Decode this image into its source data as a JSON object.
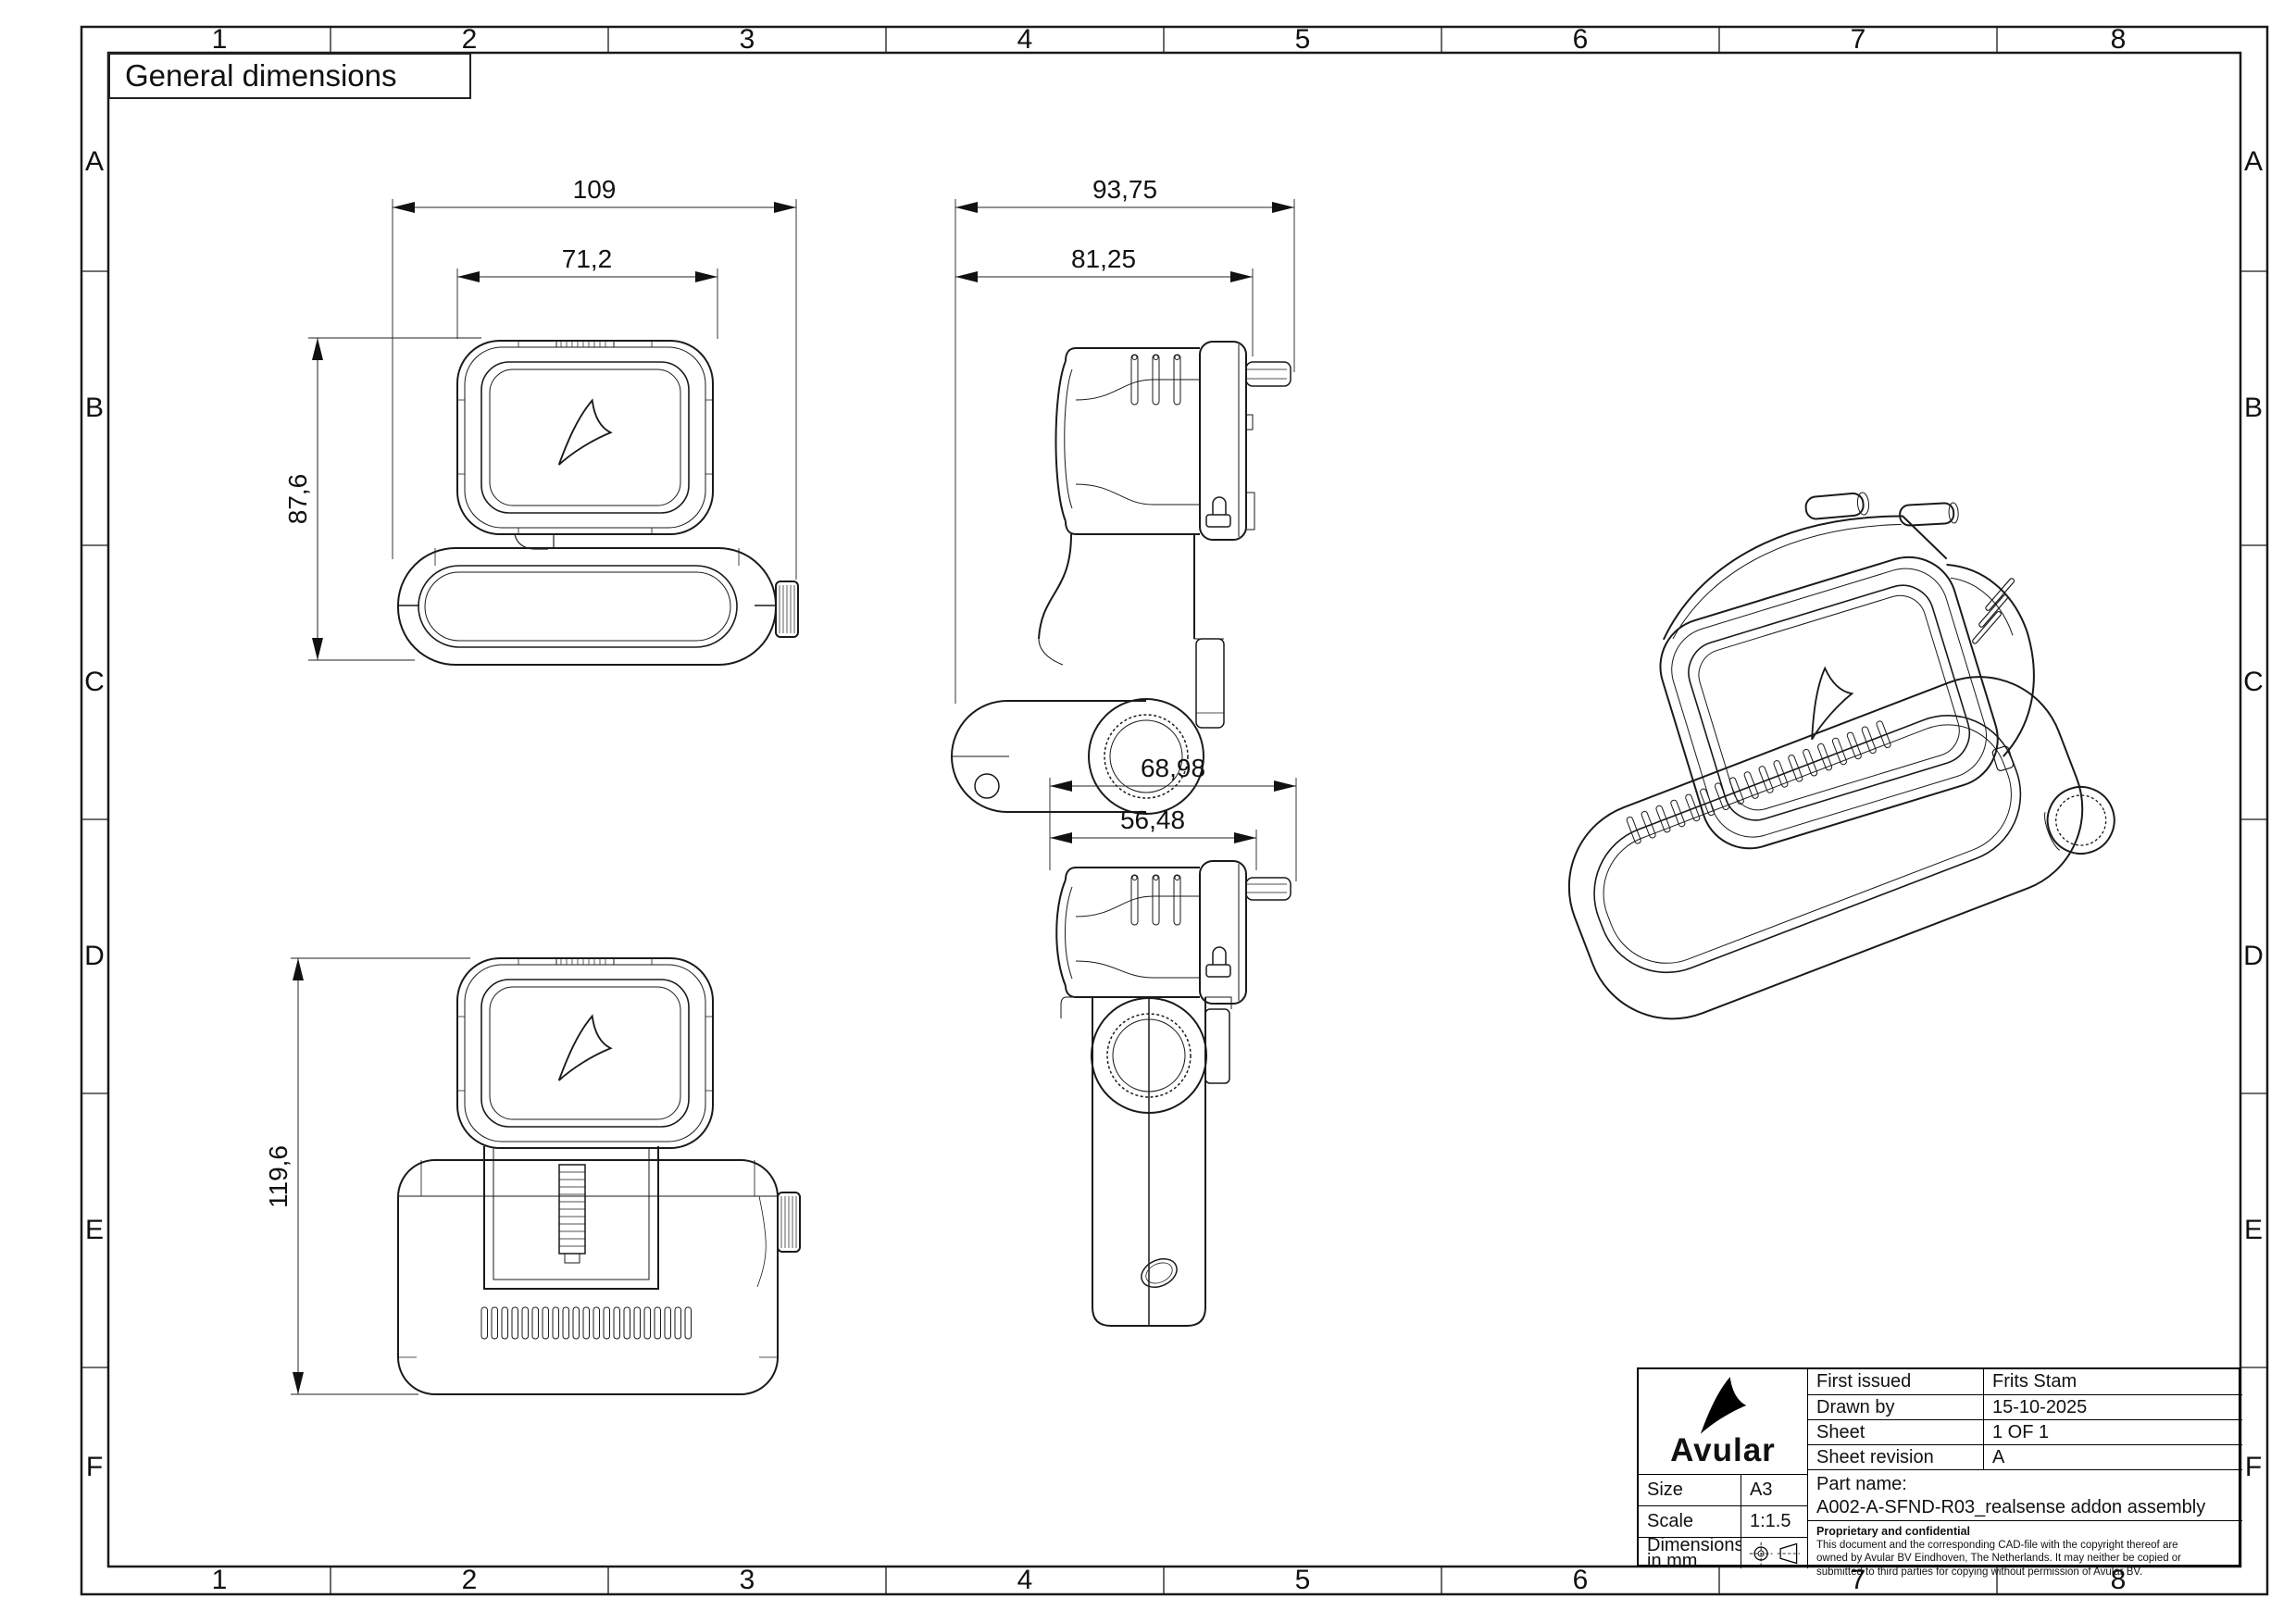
{
  "sheet": {
    "title": "General dimensions",
    "frame": {
      "columns": [
        "1",
        "2",
        "3",
        "4",
        "5",
        "6",
        "7",
        "8"
      ],
      "rows": [
        "A",
        "B",
        "C",
        "D",
        "E",
        "F"
      ]
    }
  },
  "views": {
    "front": {
      "overall_width": "109",
      "screen_width": "71,2",
      "height": "87,6"
    },
    "side": {
      "overall_depth": "93,75",
      "body_depth": "81,25"
    },
    "rear": {
      "overall_height": "119,6"
    },
    "side_rotated": {
      "overall_depth": "68,98",
      "body_depth": "56,48"
    }
  },
  "title_block": {
    "logo_text": "Avular",
    "info_rows": [
      {
        "label": "First issued",
        "value": "Frits Stam"
      },
      {
        "label": "Drawn by",
        "value": "15-10-2025"
      },
      {
        "label": "Sheet",
        "value": "1 OF 1"
      },
      {
        "label": "Sheet revision",
        "value": "A"
      }
    ],
    "part_name_label": "Part name:",
    "part_name": "A002-A-SFND-R03_realsense addon assembly",
    "size_label": "Size",
    "size_value": "A3",
    "scale_label": "Scale",
    "scale_value": "1:1.5",
    "dimensions_label_line1": "Dimensions",
    "dimensions_label_line2": "in mm",
    "proprietary_title": "Proprietary and confidential",
    "proprietary_lines": [
      "This document and the corresponding CAD-file with the copyright thereof are",
      "owned by Avular BV Eindhoven, The Netherlands. It may neither be copied or",
      "submitted to third parties for copying without permission of Avular BV."
    ]
  }
}
